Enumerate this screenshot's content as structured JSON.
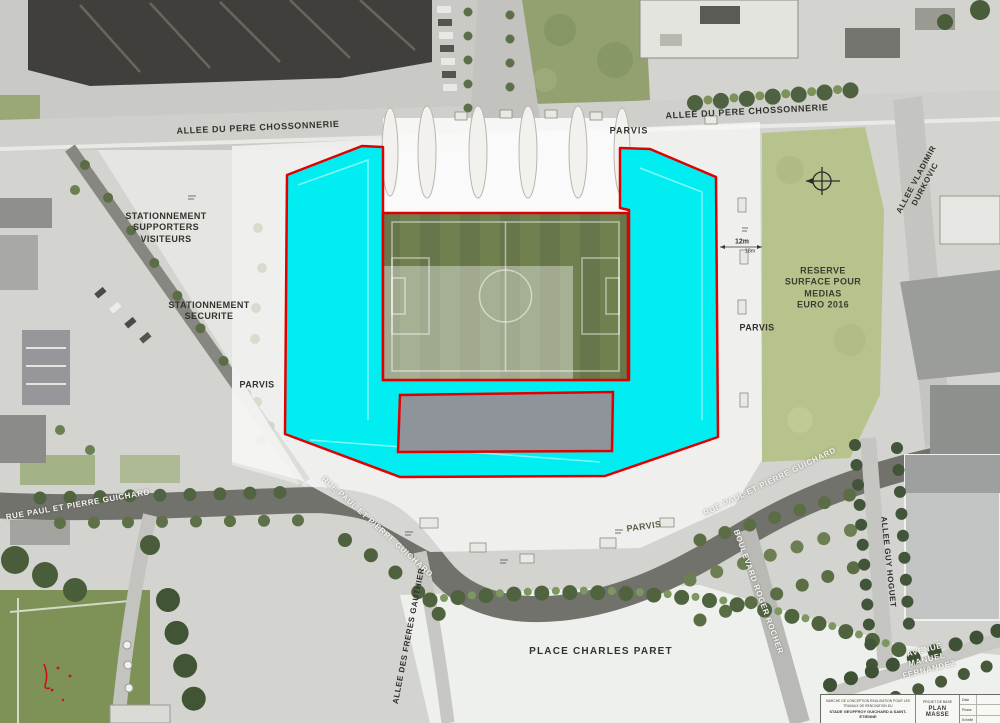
{
  "map_labels": {
    "allee_pere_chossonnerie_left": "ALLEE DU PERE CHOSSONNERIE",
    "allee_pere_chossonnerie_right": "ALLEE DU PERE CHOSSONNERIE",
    "parvis_top": "PARVIS",
    "parvis_left": "PARVIS",
    "parvis_right": "PARVIS",
    "parvis_south": "PARVIS",
    "stationnement_supporters": "STATIONNEMENT\nSUPPORTERS\nVISITEURS",
    "stationnement_securite": "STATIONNEMENT\nSECURITE",
    "reserve_medias": "RESERVE\nSURFACE POUR\nMEDIAS\nEURO 2016",
    "allee_vladimir_durkovic": "ALLEE VLADIMIR DURKOVIC",
    "rue_paul_guichard_left": "RUE PAUL ET PIERRE GUICHARD",
    "rue_paul_guichard_mid": "RUE PAUL ET PIERRE GUICHARD",
    "rue_paul_guichard_right": "RUE PAUL ET PIERRE GUICHARD",
    "boulevard_roger_rocher": "BOULEVARD ROGER ROCHER",
    "allee_guy_hoguet": "ALLEE GUY HOGUET",
    "allee_des_freres_gauthier": "ALLEE DES FRERES GAUTHIER",
    "place_charles_paret": "PLACE CHARLES PARET",
    "avenue_manuel_fernandez": "AVENUE MANUEL FERNANDEZ",
    "dim_12m": "12m",
    "dim_18m": "18m"
  },
  "title_block": {
    "project_line1": "MARCHE DE CONCEPTION REALISATION POUR LES TRAVAUX DE RENOVATION DU",
    "project_line2": "STADE GEOFFROY GUICHARD A SAINT-ETIENNE",
    "phase": "PROJET DE BASE",
    "drawing_title": "PLAN MASSE",
    "meta_rows": [
      {
        "label": "Date",
        "value": ""
      },
      {
        "label": "Phase",
        "value": ""
      },
      {
        "label": "Echelle",
        "value": ""
      }
    ]
  },
  "colors": {
    "highlight_cyan": "#00eef2",
    "outline_red": "#e10000",
    "pitch_green_dark": "#68774b",
    "roof_gray": "#8f939a"
  }
}
